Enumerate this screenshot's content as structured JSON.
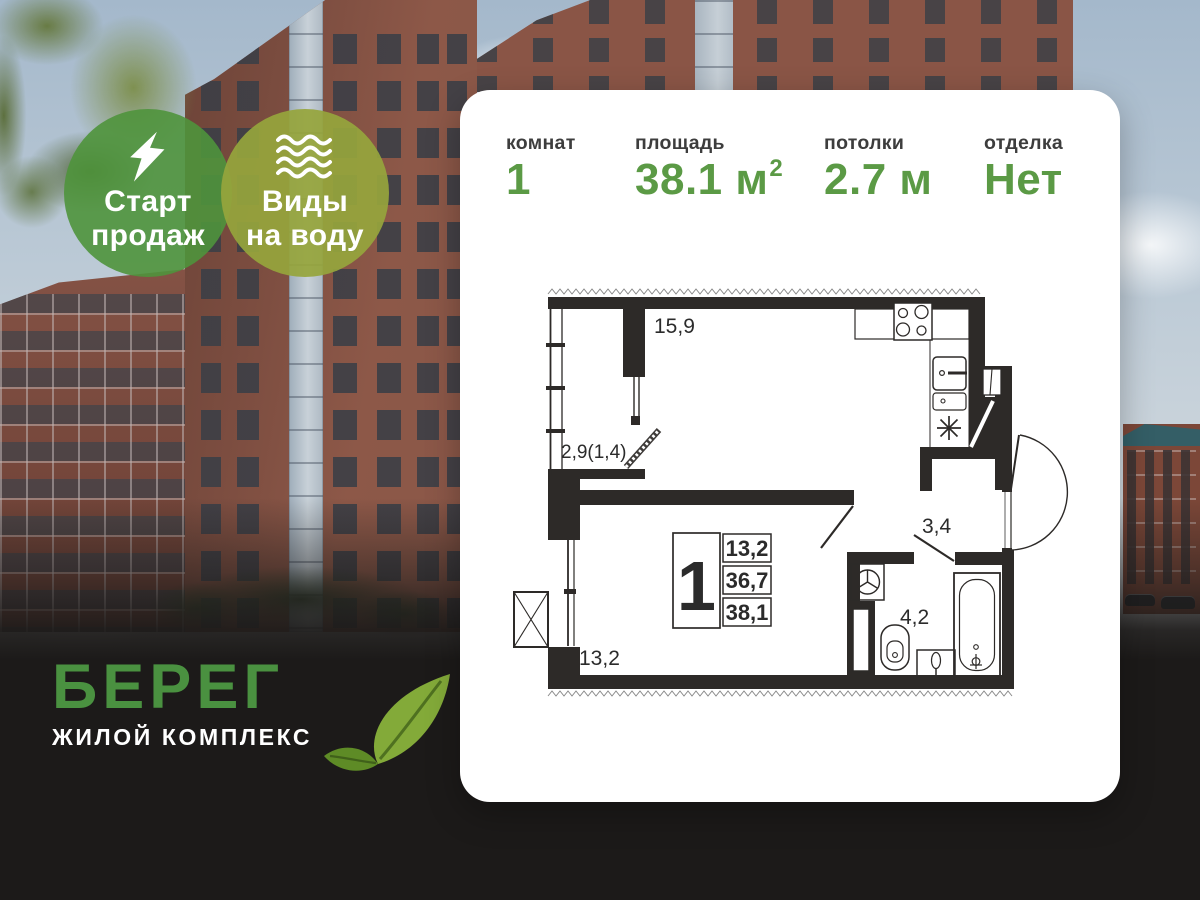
{
  "badges": [
    {
      "icon": "lightning-icon",
      "lines": [
        "Старт",
        "продаж"
      ],
      "color": "#4f933c"
    },
    {
      "icon": "waves-icon",
      "lines": [
        "Виды",
        "на воду"
      ],
      "color": "#96a53d"
    }
  ],
  "logo": {
    "name": "БЕРЕГ",
    "subtitle": "ЖИЛОЙ КОМПЛЕКС",
    "color": "#4a9140"
  },
  "card": {
    "stats": [
      {
        "label": "комнат",
        "value": "1",
        "sup": ""
      },
      {
        "label": "площадь",
        "value": "38.1 м",
        "sup": "2"
      },
      {
        "label": "потолки",
        "value": "2.7 м",
        "sup": ""
      },
      {
        "label": "отделка",
        "value": "Нет",
        "sup": ""
      }
    ],
    "value_color": "#5b9a45",
    "plan": {
      "kitchen_living_area": "15,9",
      "balcony_area": "2,9(1,4)",
      "room_area": "13,2",
      "hallway_area": "3,4",
      "bathroom_area": "4,2",
      "info_box": {
        "rooms": "1",
        "row1": "13,2",
        "row2": "36,7",
        "row3": "38,1"
      }
    }
  }
}
